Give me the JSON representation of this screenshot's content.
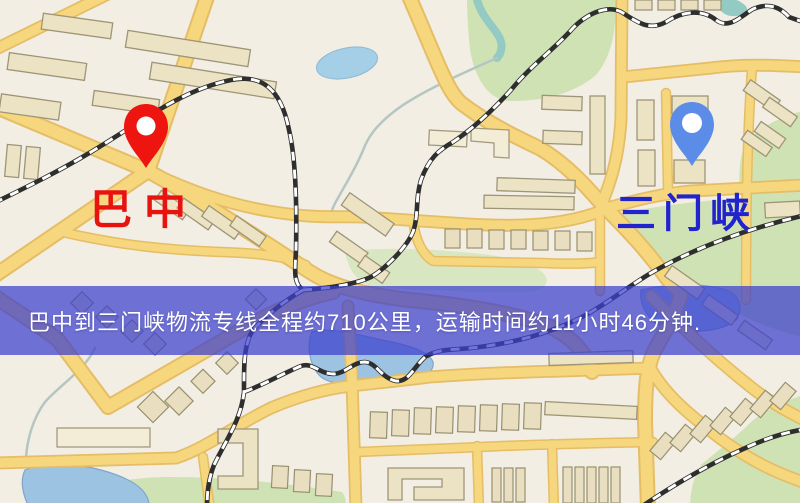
{
  "map": {
    "markers": {
      "origin": {
        "label": "巴中",
        "text_color": "#e8120e",
        "pin_color": "#ee1410"
      },
      "destination": {
        "label": "三门峡",
        "text_color": "#2123cd",
        "pin_color": "#5b8ce8"
      }
    },
    "banner": {
      "text": "巴中到三门峡物流专线全程约710公里，运输时间约11小时46分钟.",
      "background": "#3c40cd",
      "text_color": "#ffffff"
    },
    "route_info": {
      "origin": "巴中",
      "destination": "三门峡",
      "distance_text": "约710公里",
      "duration_text": "约11小时46分钟"
    },
    "palette": {
      "background": "#f2eee3",
      "road": "#f6d77e",
      "road_casing": "#e5bd66",
      "building": "#ece3c4",
      "park_green": "#cfe2b4",
      "water": "#a4cfe6",
      "railway": "#2e2e2e"
    }
  }
}
